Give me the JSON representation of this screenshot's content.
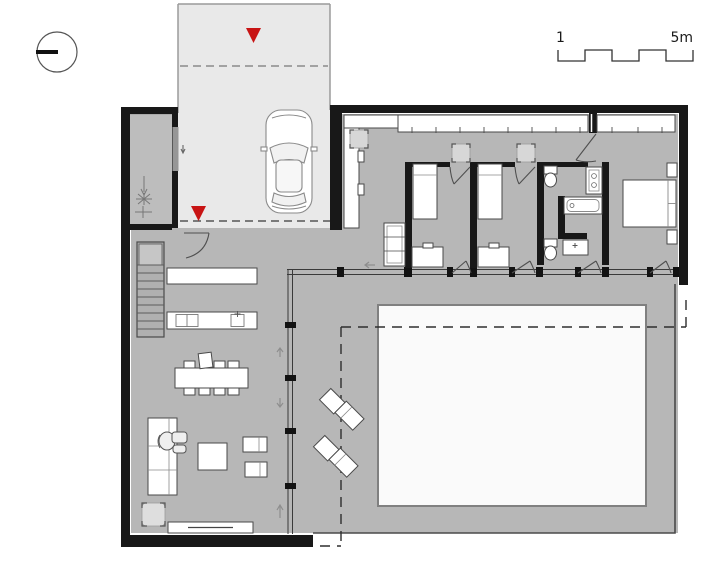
{
  "drawing": {
    "kind": "architectural floor plan, ground floor of an L-shaped villa with garage, patio and pool court",
    "scale_bar": {
      "start_label": "1",
      "end_label": "5m"
    },
    "symbols": {
      "north_indicator": "circle-with-bar-icon",
      "entrance_marker": "red-triangle-icon",
      "roof_overhang": "dashed-line",
      "garage_door": "dashed-line"
    },
    "colors": {
      "background": "#ffffff",
      "floor_gray": "#b7b7b7",
      "garage_gray": "#e9e9e9",
      "entry_court_gray": "#bdbdbd",
      "wall_black": "#181818",
      "furniture_white": "#ffffff",
      "courtyard_white": "#fafafa",
      "entrance_red": "#c81414",
      "mat_gray": "#d7d7d7"
    },
    "elements": [
      "north-symbol",
      "scale-bar",
      "garage",
      "car",
      "entrance-markers",
      "entry-court-with-tree",
      "staircase",
      "kitchen-counter",
      "kitchen-island",
      "dining-table-with-chairs",
      "sofa",
      "lounge-chair",
      "coffee-table",
      "side-tables",
      "pouf",
      "tv-bench",
      "entry-wardrobe",
      "hall-closet",
      "shelf-unit",
      "bedroom-1-bed",
      "bedroom-1-dresser",
      "bedroom-2-bed",
      "bedroom-2-dresser",
      "bathroom-bathtub",
      "bathroom-vanity",
      "bathroom-wc",
      "bathroom-sink",
      "master-bed",
      "nightstands",
      "glass-facade",
      "terrace",
      "pool-court",
      "sun-loungers"
    ]
  }
}
